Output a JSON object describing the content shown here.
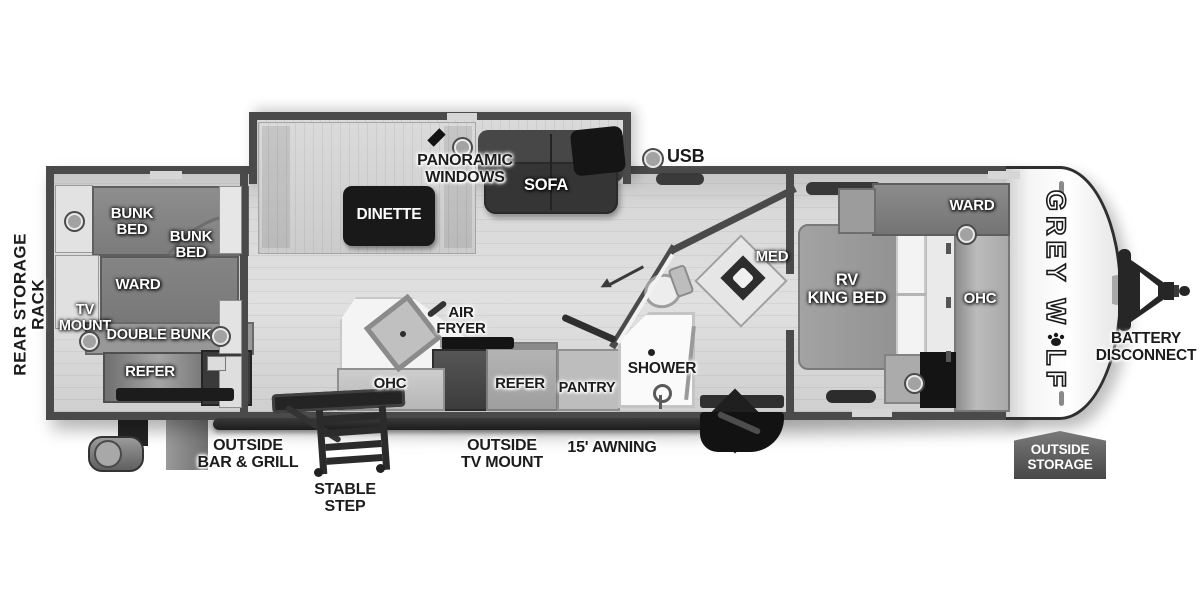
{
  "legend": {
    "usb": "USB"
  },
  "exterior": {
    "rear_storage_rack": "REAR STORAGE RACK",
    "outside_bar_grill": "OUTSIDE\nBAR & GRILL",
    "stable_step": "STABLE STEP",
    "outside_tv_mount": "OUTSIDE\nTV MOUNT",
    "awning": "15' AWNING",
    "battery_disconnect": "BATTERY\nDISCONNECT",
    "outside_storage": "OUTSIDE\nSTORAGE",
    "brand_prefix": "GREY W",
    "brand_suffix": "LF"
  },
  "bunk_room": {
    "bunk_bed_upper": "BUNK BED",
    "bunk_bed_lower": "BUNK BED",
    "ward": "WARD",
    "tv_mount": "TV\nMOUNT",
    "double_bunk": "DOUBLE BUNK",
    "refer": "REFER"
  },
  "living": {
    "panoramic_windows": "PANORAMIC WINDOWS",
    "dinette": "DINETTE",
    "sofa": "SOFA"
  },
  "kitchen": {
    "air_fryer": "AIR\nFRYER",
    "ohc": "OHC",
    "refer": "REFER",
    "pantry": "PANTRY"
  },
  "bathroom": {
    "shower": "SHOWER",
    "med": "MED"
  },
  "bedroom": {
    "king_bed": "RV\nKING BED",
    "ward": "WARD",
    "ohc": "OHC"
  },
  "colors": {
    "wall": "#4a4a4a",
    "floor": "#d7d7d7",
    "furniture_dark": "#1e1e1e",
    "badge": "#555555",
    "label_light": "#ffffff",
    "label_dark": "#1c1c1c"
  }
}
